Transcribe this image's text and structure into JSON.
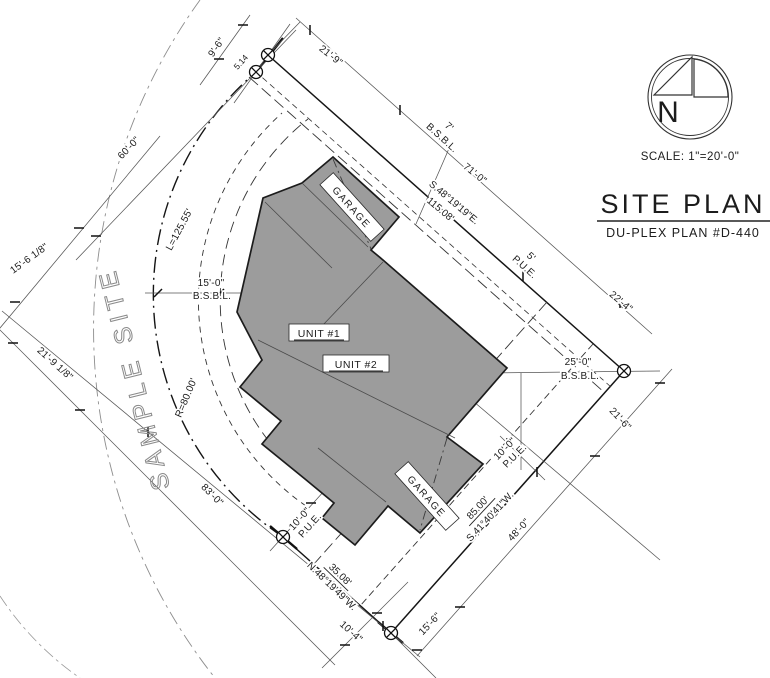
{
  "watermark": "SAMPLE SITE",
  "title_block": {
    "north_letter": "N",
    "scale": "SCALE: 1\"=20'-0\"",
    "title": "SITE PLAN",
    "subtitle": "DU-PLEX PLAN #D-440"
  },
  "building": {
    "unit1": "UNIT #1",
    "unit2": "UNIT #2",
    "garage_upper": "GARAGE",
    "garage_lower": "GARAGE"
  },
  "boundary": {
    "ne_bearing": "S.48°19'19\"E.",
    "ne_distance": "115.08'",
    "se_distance": "85.00'",
    "se_bearing": "S.41°40'41\"W.",
    "s_distance": "35.08'",
    "s_bearing": "N.48°19'49\"W.",
    "curve_length": "L=125.55'",
    "curve_radius": "R=80.00'",
    "monument_gap": "5.14"
  },
  "labels": {
    "pue": "P.U.E.",
    "bsbl": "B.S.B.L."
  },
  "dims": {
    "d9_6": "9'-6\"",
    "d21_9": "21'-9\"",
    "d60_0": "60'-0\"",
    "d15_6_18": "15'-6 1/8\"",
    "d21_9_18": "21'-9 1/8\"",
    "d83_0": "83'-0\"",
    "d15_0": "15'-0\"",
    "d25_0": "25'-0\"",
    "d7": "7'",
    "d5": "5'",
    "d71_0": "71'-0\"",
    "d22_4": "22'-4\"",
    "d21_6": "21'-6\"",
    "d48_0": "48'-0\"",
    "d15_6": "15'-6\"",
    "d10_4": "10'-4\"",
    "d10_0": "10'-0\""
  }
}
